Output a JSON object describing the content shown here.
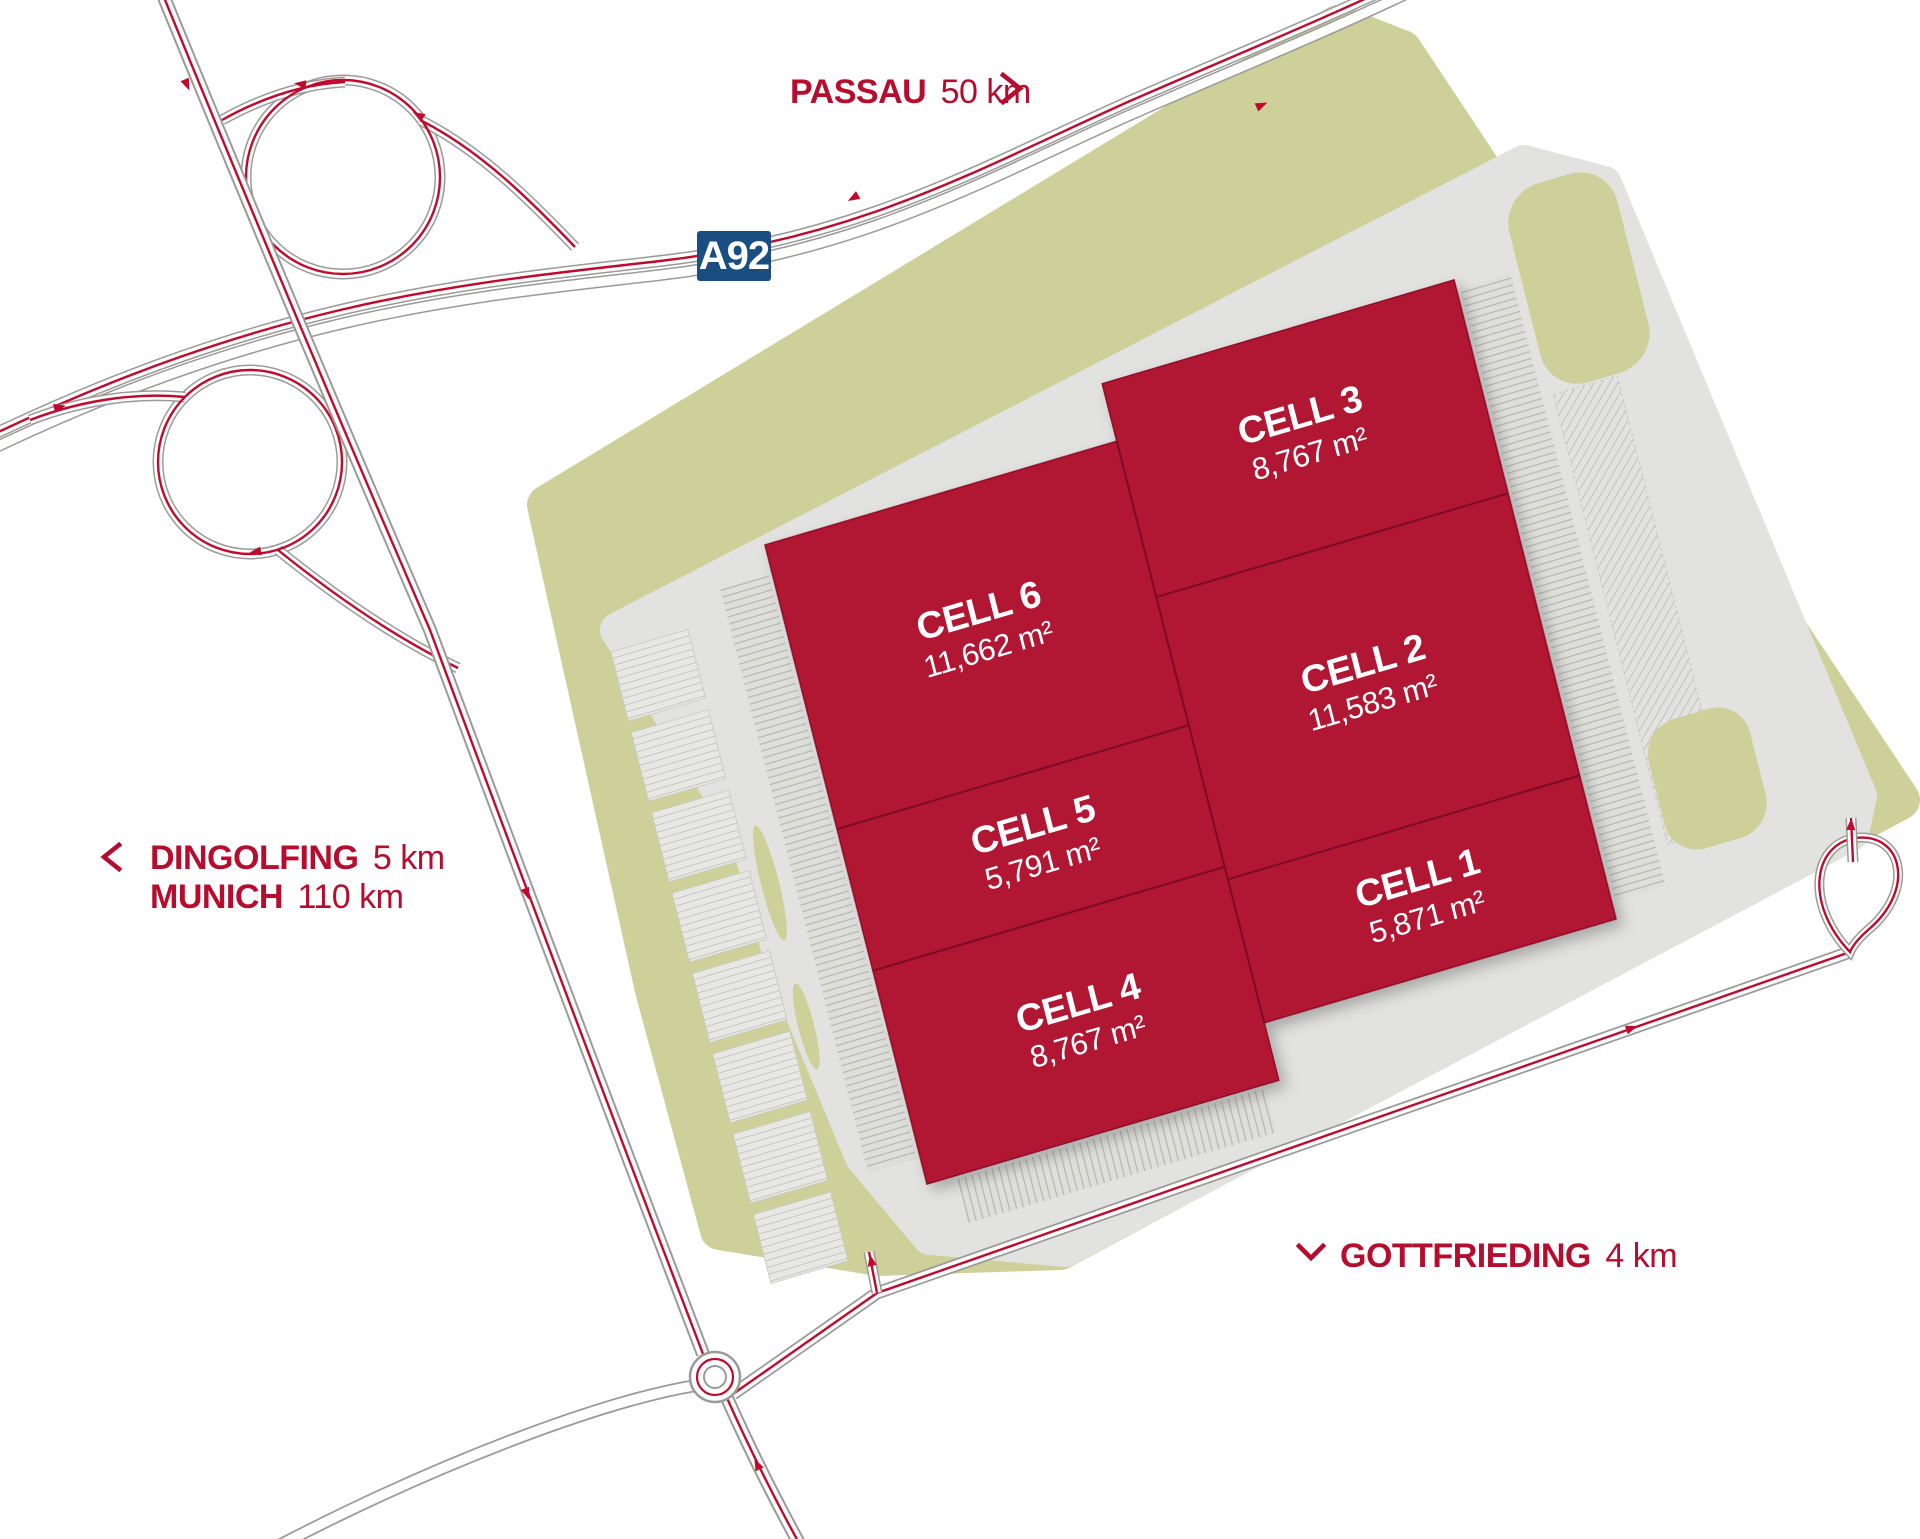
{
  "directions": {
    "passau": {
      "city": "PASSAU",
      "distance": "50 km",
      "chevron": "right"
    },
    "dingolfing": {
      "city": "DINGOLFING",
      "distance": "5 km",
      "chevron": "left"
    },
    "munich": {
      "city": "MUNICH",
      "distance": "110 km",
      "chevron": ""
    },
    "gottfrieding": {
      "city": "GOTTFRIEDING",
      "distance": "4 km",
      "chevron": "down"
    }
  },
  "motorway": {
    "badge": "A92"
  },
  "cells": [
    {
      "name": "CELL 1",
      "area": "5,871 m²"
    },
    {
      "name": "CELL 2",
      "area": "11,583 m²"
    },
    {
      "name": "CELL 3",
      "area": "8,767 m²"
    },
    {
      "name": "CELL 4",
      "area": "8,767 m²"
    },
    {
      "name": "CELL 5",
      "area": "5,791 m²"
    },
    {
      "name": "CELL 6",
      "area": "11,662 m²"
    }
  ],
  "colors": {
    "building_red": "#b11230",
    "cell_divider_red": "#7d0b23",
    "site_green": "#cdd199",
    "pavement_gray": "#e2e2e0",
    "road_line_red": "#c00a2d",
    "road_casing_gray": "#9a9a98",
    "label_red": "#b60d2f",
    "badge_blue": "#1b4e80"
  }
}
